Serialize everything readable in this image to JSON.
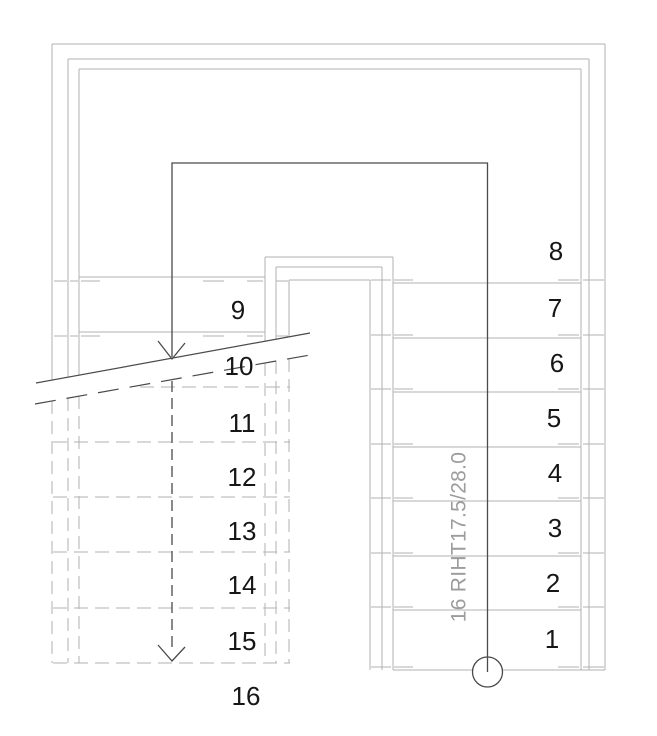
{
  "drawing": {
    "type_label": "stair-plan",
    "annotation": "16 RIHT17.5/28.0",
    "step_numbers": [
      {
        "label": "1",
        "x": 552,
        "y": 639
      },
      {
        "label": "2",
        "x": 553,
        "y": 583
      },
      {
        "label": "3",
        "x": 555,
        "y": 528
      },
      {
        "label": "4",
        "x": 555,
        "y": 473
      },
      {
        "label": "5",
        "x": 554,
        "y": 418
      },
      {
        "label": "6",
        "x": 557,
        "y": 363
      },
      {
        "label": "7",
        "x": 555,
        "y": 308
      },
      {
        "label": "8",
        "x": 556,
        "y": 251
      },
      {
        "label": "9",
        "x": 238,
        "y": 310
      },
      {
        "label": "10",
        "x": 239,
        "y": 366
      },
      {
        "label": "11",
        "x": 242,
        "y": 423
      },
      {
        "label": "12",
        "x": 242,
        "y": 477
      },
      {
        "label": "13",
        "x": 242,
        "y": 531
      },
      {
        "label": "14",
        "x": 242,
        "y": 585
      },
      {
        "label": "15",
        "x": 242,
        "y": 641
      },
      {
        "label": "16",
        "x": 246,
        "y": 696
      }
    ]
  },
  "colors": {
    "wall_gray": "#b2b2b2",
    "dark_line": "#4a4a4a",
    "number_black": "#161616",
    "annotation_gray": "#9c9c9c",
    "background": "#ffffff"
  }
}
